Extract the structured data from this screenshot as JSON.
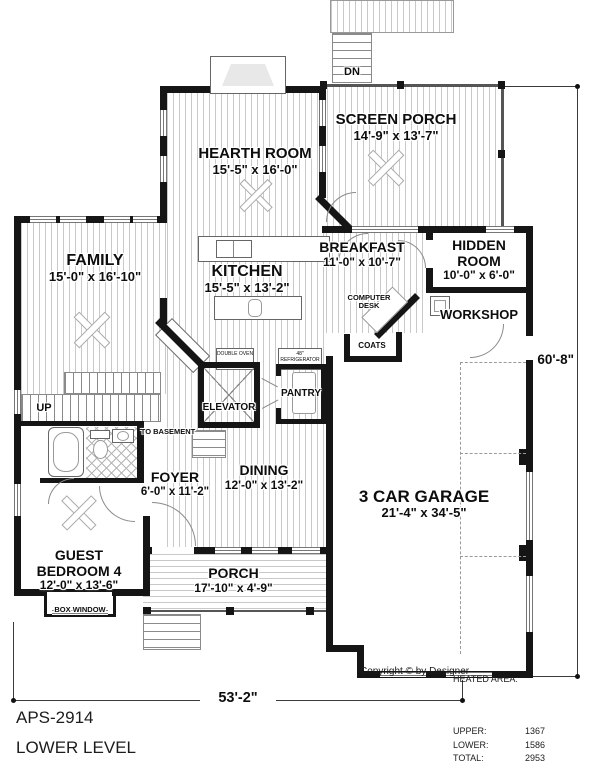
{
  "rooms": {
    "hearth": {
      "name": "HEARTH ROOM",
      "dims": "15'-5\" x 16'-0\""
    },
    "screen_porch": {
      "name": "SCREEN PORCH",
      "dims": "14'-9\" x 13'-7\""
    },
    "family": {
      "name": "FAMILY",
      "dims": "15'-0\" x 16'-10\""
    },
    "kitchen": {
      "name": "KITCHEN",
      "dims": "15'-5\" x 13'-2\""
    },
    "breakfast": {
      "name": "BREAKFAST",
      "dims": "11'-0\" x 10'-7\""
    },
    "hidden": {
      "name": "HIDDEN ROOM",
      "dims": "10'-0\" x 6'-0\""
    },
    "workshop": {
      "name": "WORKSHOP"
    },
    "garage": {
      "name": "3 CAR GARAGE",
      "dims": "21'-4\" x 34'-5\""
    },
    "dining": {
      "name": "DINING",
      "dims": "12'-0\" x 13'-2\""
    },
    "foyer": {
      "name": "FOYER",
      "dims": "6'-0\" x 11'-2\""
    },
    "guest": {
      "name": "GUEST BEDROOM 4",
      "dims": "12'-0\" x 13'-6\""
    },
    "porch": {
      "name": "PORCH",
      "dims": "17'-10\" x 4'-9\""
    }
  },
  "features": {
    "elevator": "ELEVATOR",
    "pantry": "PANTRY",
    "coats": "COATS",
    "computer_desk": "COMPUTER DESK",
    "to_basement": "TO BASEMENT",
    "up": "UP",
    "dn": "DN",
    "box_window": "BOX WINDOW",
    "double_oven": "DOUBLE OVEN",
    "refrigerator": "48\" REFRIGERATOR"
  },
  "dimensions": {
    "overall_width": "53'-2\"",
    "overall_depth": "60'-8\""
  },
  "annotations": {
    "copyright": "Copyright © by Designer"
  },
  "footer": {
    "plan_id": "APS-2914",
    "level": "LOWER LEVEL"
  },
  "heated_area": {
    "title": "HEATED AREA:",
    "rows": [
      {
        "label": "UPPER:",
        "value": "1367"
      },
      {
        "label": "LOWER:",
        "value": "1586"
      },
      {
        "label": "TOTAL:",
        "value": "2953"
      }
    ]
  },
  "colors": {
    "wall": "#151515",
    "hatch": "#c9c9c9",
    "background": "#ffffff"
  }
}
